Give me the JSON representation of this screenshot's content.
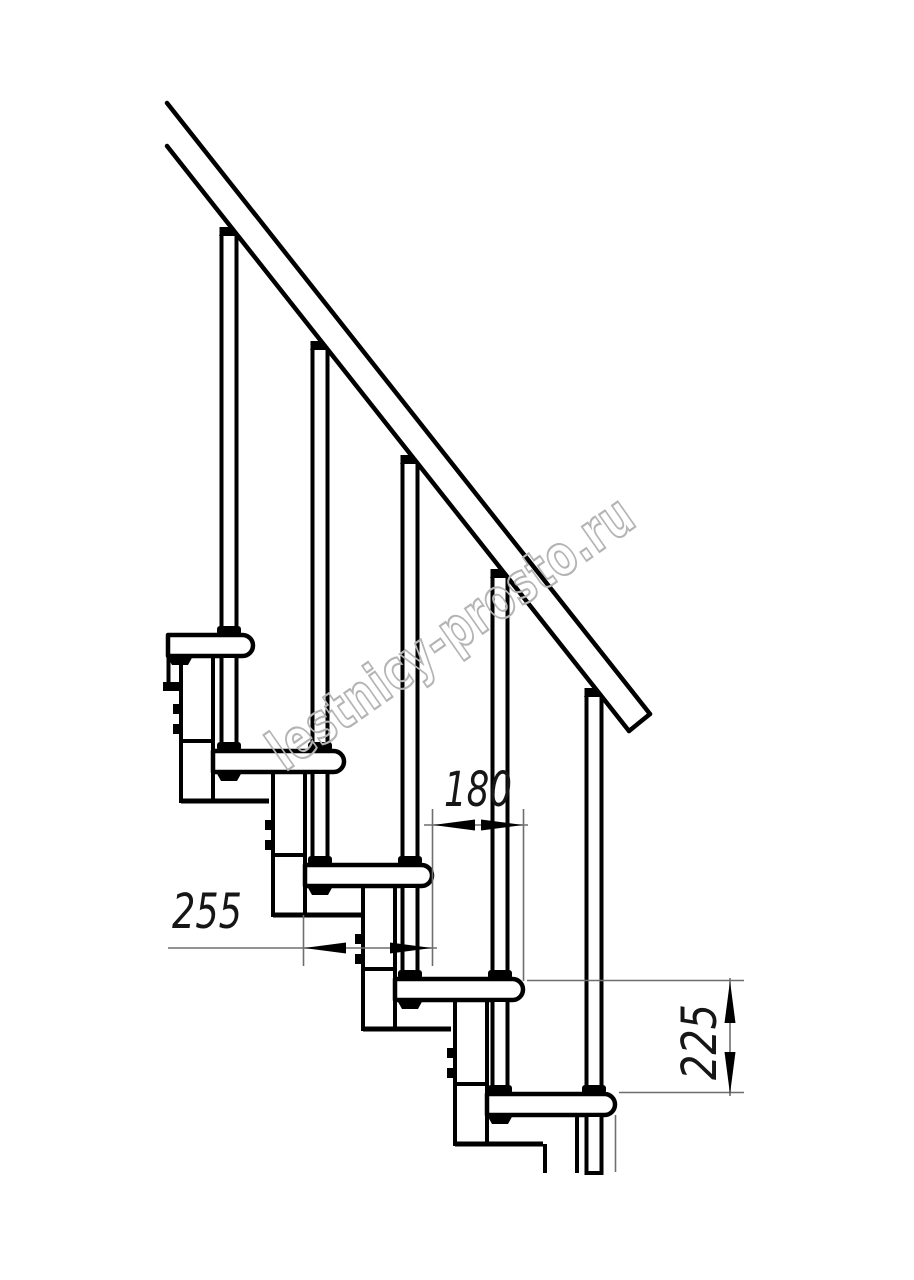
{
  "drawing": {
    "title": "modular-staircase-side-view",
    "watermark": "lestnicy-prosto.ru",
    "dimensions": {
      "tread_depth": "255",
      "going": "180",
      "riser_height": "225"
    },
    "colors": {
      "line": "#000000",
      "thin_line": "#6e6e6e",
      "watermark": "#b4b4b4",
      "background": "#ffffff"
    }
  }
}
